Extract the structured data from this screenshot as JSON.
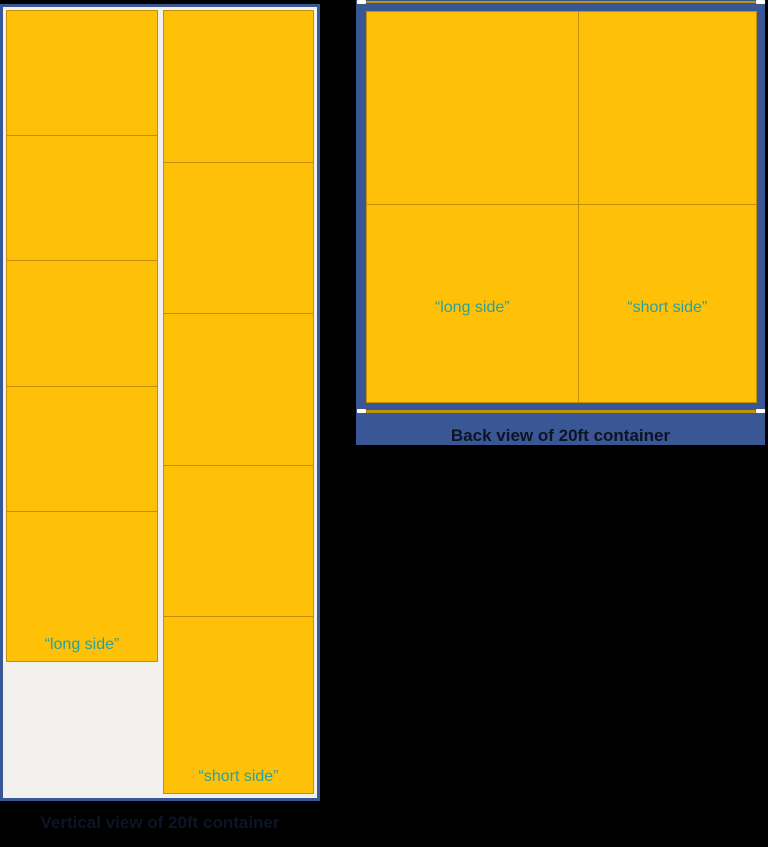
{
  "colors": {
    "page_bg": "#000000",
    "container_blue": "#3A5795",
    "container_inner": "#F2F1ED",
    "box_fill": "#FFC107",
    "box_border": "#C28F06",
    "label_teal": "#2BA19B",
    "caption_dark": "#0D1426",
    "line_gold": "#C0930E",
    "handle_white": "#FFFFFF"
  },
  "vertical_view": {
    "caption": "Vertical view of 20ft container",
    "long_column": {
      "label": "“long side”",
      "box_count": 5
    },
    "short_column": {
      "label": "“short side”",
      "box_count": 5
    }
  },
  "back_view": {
    "caption": "Back view of 20ft container",
    "grid": "2x2",
    "bottom_left_label": "“long side”",
    "bottom_right_label": "“short side”"
  }
}
